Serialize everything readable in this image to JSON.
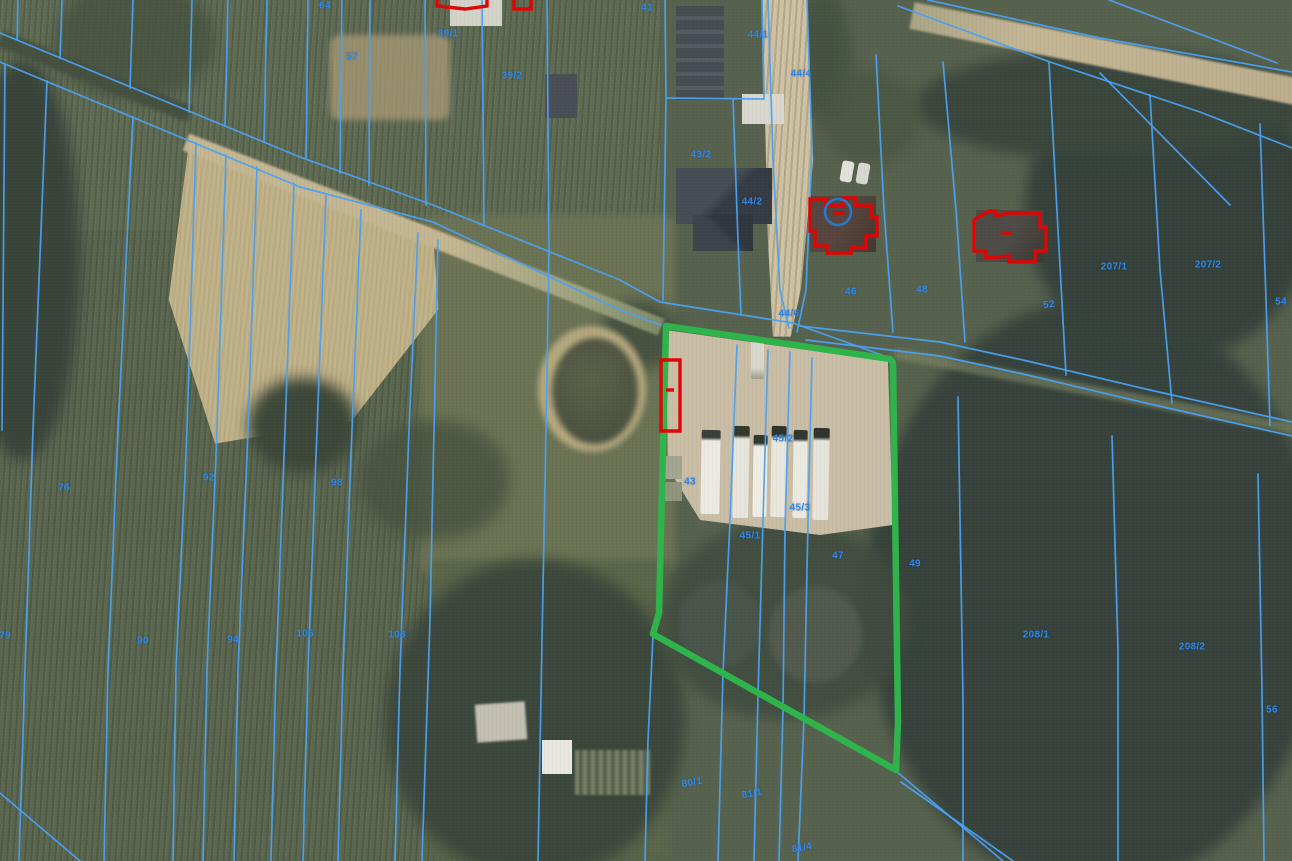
{
  "map": {
    "type": "aerial-cadastral-map",
    "colors": {
      "parcel_line": "#4aa1f2",
      "parcel_label": "#2e86e8",
      "selection_outline": "#2eb44b",
      "building_outline": "#e00505",
      "annotation_circle": "#2679c8"
    },
    "selected_parcel": {
      "points": [
        [
          666,
          326
        ],
        [
          890,
          359
        ],
        [
          893,
          363
        ],
        [
          898,
          722
        ],
        [
          896,
          770
        ],
        [
          653,
          634
        ],
        [
          659,
          613
        ],
        [
          666,
          326
        ]
      ]
    },
    "annotation": {
      "circle": {
        "cx": 838,
        "cy": 212,
        "r": 13
      }
    },
    "building_outlines": [
      {
        "id": "outbuilding-strip",
        "closed": true,
        "points": [
          [
            661,
            360
          ],
          [
            680,
            360
          ],
          [
            680,
            431
          ],
          [
            661,
            431
          ]
        ]
      },
      {
        "id": "outbuilding-strip-mark",
        "closed": false,
        "points": [
          [
            666,
            390
          ],
          [
            674,
            390
          ]
        ]
      },
      {
        "id": "house-a",
        "closed": true,
        "points": [
          [
            810,
            214
          ],
          [
            810,
            199
          ],
          [
            826,
            199
          ],
          [
            826,
            206
          ],
          [
            843,
            206
          ],
          [
            843,
            198
          ],
          [
            855,
            198
          ],
          [
            855,
            206
          ],
          [
            871,
            206
          ],
          [
            871,
            217
          ],
          [
            877,
            217
          ],
          [
            877,
            236
          ],
          [
            866,
            236
          ],
          [
            866,
            248
          ],
          [
            851,
            248
          ],
          [
            851,
            253
          ],
          [
            827,
            253
          ],
          [
            827,
            246
          ],
          [
            815,
            246
          ],
          [
            815,
            231
          ],
          [
            810,
            231
          ]
        ]
      },
      {
        "id": "house-a-mark",
        "closed": false,
        "points": [
          [
            833,
            213
          ],
          [
            844,
            213
          ]
        ]
      },
      {
        "id": "house-b",
        "closed": true,
        "points": [
          [
            974,
            220
          ],
          [
            989,
            211
          ],
          [
            996,
            211
          ],
          [
            996,
            216
          ],
          [
            1009,
            213
          ],
          [
            1040,
            213
          ],
          [
            1040,
            227
          ],
          [
            1046,
            227
          ],
          [
            1046,
            251
          ],
          [
            1035,
            251
          ],
          [
            1035,
            262
          ],
          [
            1009,
            262
          ],
          [
            1009,
            256
          ],
          [
            986,
            258
          ],
          [
            986,
            251
          ],
          [
            974,
            251
          ]
        ]
      },
      {
        "id": "house-b-mark",
        "closed": false,
        "points": [
          [
            1002,
            233
          ],
          [
            1012,
            233
          ]
        ]
      },
      {
        "id": "top-partial-1",
        "closed": false,
        "points": [
          [
            437,
            0
          ],
          [
            437,
            6
          ],
          [
            465,
            9
          ],
          [
            487,
            6
          ],
          [
            487,
            0
          ]
        ]
      },
      {
        "id": "top-partial-2",
        "closed": false,
        "points": [
          [
            514,
            0
          ],
          [
            514,
            9
          ],
          [
            531,
            9
          ],
          [
            531,
            0
          ]
        ]
      }
    ],
    "parcel_labels": [
      {
        "t": "64",
        "x": 325,
        "y": 6
      },
      {
        "t": "41",
        "x": 647,
        "y": 8
      },
      {
        "t": "57",
        "x": 352,
        "y": 57
      },
      {
        "t": "39/1",
        "x": 448,
        "y": 34
      },
      {
        "t": "39/2",
        "x": 512,
        "y": 76
      },
      {
        "t": "44/1",
        "x": 758,
        "y": 35
      },
      {
        "t": "44/4",
        "x": 801,
        "y": 74
      },
      {
        "t": "43/2",
        "x": 701,
        "y": 155
      },
      {
        "t": "44/2",
        "x": 752,
        "y": 202
      },
      {
        "t": "44/6",
        "x": 789,
        "y": 314
      },
      {
        "t": "46",
        "x": 851,
        "y": 292
      },
      {
        "t": "48",
        "x": 922,
        "y": 290
      },
      {
        "t": "52",
        "x": 1049,
        "y": 305,
        "r": -8
      },
      {
        "t": "207/1",
        "x": 1114,
        "y": 267
      },
      {
        "t": "207/2",
        "x": 1208,
        "y": 265
      },
      {
        "t": "54",
        "x": 1281,
        "y": 302
      },
      {
        "t": "76",
        "x": 64,
        "y": 488
      },
      {
        "t": "92",
        "x": 209,
        "y": 478
      },
      {
        "t": "98",
        "x": 337,
        "y": 483
      },
      {
        "t": "79",
        "x": 5,
        "y": 636
      },
      {
        "t": "90",
        "x": 143,
        "y": 641
      },
      {
        "t": "94",
        "x": 233,
        "y": 640
      },
      {
        "t": "105",
        "x": 305,
        "y": 634
      },
      {
        "t": "108",
        "x": 397,
        "y": 635
      },
      {
        "t": "43",
        "x": 690,
        "y": 482
      },
      {
        "t": "45/2",
        "x": 783,
        "y": 439
      },
      {
        "t": "45/1",
        "x": 750,
        "y": 536
      },
      {
        "t": "45/3",
        "x": 800,
        "y": 508
      },
      {
        "t": "47",
        "x": 838,
        "y": 556
      },
      {
        "t": "49",
        "x": 915,
        "y": 564
      },
      {
        "t": "208/1",
        "x": 1036,
        "y": 635
      },
      {
        "t": "208/2",
        "x": 1192,
        "y": 647
      },
      {
        "t": "56",
        "x": 1272,
        "y": 710
      },
      {
        "t": "80/1",
        "x": 692,
        "y": 783,
        "r": -10
      },
      {
        "t": "81/1",
        "x": 752,
        "y": 794,
        "r": -10
      },
      {
        "t": "81/4",
        "x": 802,
        "y": 848,
        "r": -10
      }
    ],
    "cadastral_lines": [
      {
        "pts": [
          [
            0,
            33
          ],
          [
            300,
            157
          ],
          [
            433,
            205
          ],
          [
            620,
            280
          ],
          [
            660,
            302
          ],
          [
            793,
            323
          ],
          [
            890,
            358
          ]
        ]
      },
      {
        "pts": [
          [
            0,
            62
          ],
          [
            300,
            187
          ],
          [
            433,
            222
          ],
          [
            620,
            310
          ],
          [
            661,
            325
          ]
        ]
      },
      {
        "pts": [
          [
            18,
            0
          ],
          [
            17,
            40
          ]
        ]
      },
      {
        "pts": [
          [
            62,
            0
          ],
          [
            60,
            58
          ]
        ]
      },
      {
        "pts": [
          [
            133,
            0
          ],
          [
            130,
            88
          ]
        ]
      },
      {
        "pts": [
          [
            192,
            0
          ],
          [
            189,
            112
          ]
        ]
      },
      {
        "pts": [
          [
            228,
            0
          ],
          [
            225,
            126
          ]
        ]
      },
      {
        "pts": [
          [
            267,
            0
          ],
          [
            264,
            142
          ]
        ]
      },
      {
        "pts": [
          [
            308,
            0
          ],
          [
            306,
            159
          ]
        ]
      },
      {
        "pts": [
          [
            342,
            0
          ],
          [
            340,
            173
          ]
        ]
      },
      {
        "pts": [
          [
            370,
            0
          ],
          [
            369,
            185
          ]
        ]
      },
      {
        "pts": [
          [
            425,
            0
          ],
          [
            426,
            205
          ]
        ]
      },
      {
        "pts": [
          [
            482,
            0
          ],
          [
            484,
            225
          ]
        ]
      },
      {
        "pts": [
          [
            547,
            0
          ],
          [
            549,
            251
          ],
          [
            546,
            430
          ],
          [
            542,
            640
          ],
          [
            538,
            861
          ]
        ]
      },
      {
        "pts": [
          [
            665,
            0
          ],
          [
            666,
            98
          ],
          [
            663,
            300
          ]
        ]
      },
      {
        "pts": [
          [
            733,
            99
          ],
          [
            738,
            240
          ],
          [
            741,
            315
          ]
        ]
      },
      {
        "pts": [
          [
            762,
            0
          ],
          [
            764,
            99
          ]
        ]
      },
      {
        "pts": [
          [
            666,
            98
          ],
          [
            764,
            99
          ]
        ]
      },
      {
        "pts": [
          [
            768,
            0
          ],
          [
            773,
            160
          ],
          [
            780,
            290
          ],
          [
            789,
            328
          ]
        ]
      },
      {
        "pts": [
          [
            807,
            0
          ],
          [
            812,
            150
          ],
          [
            806,
            290
          ],
          [
            797,
            332
          ]
        ]
      },
      {
        "pts": [
          [
            876,
            55
          ],
          [
            884,
            210
          ],
          [
            893,
            332
          ]
        ]
      },
      {
        "pts": [
          [
            943,
            62
          ],
          [
            956,
            210
          ],
          [
            965,
            342
          ]
        ]
      },
      {
        "pts": [
          [
            1049,
            62
          ],
          [
            1058,
            230
          ],
          [
            1066,
            375
          ]
        ]
      },
      {
        "pts": [
          [
            1150,
            95
          ],
          [
            1160,
            270
          ],
          [
            1172,
            403
          ]
        ]
      },
      {
        "pts": [
          [
            1260,
            124
          ],
          [
            1266,
            300
          ],
          [
            1270,
            425
          ]
        ]
      },
      {
        "pts": [
          [
            928,
            0
          ],
          [
            1100,
            38
          ],
          [
            1292,
            72
          ]
        ]
      },
      {
        "pts": [
          [
            898,
            6
          ],
          [
            1050,
            62
          ],
          [
            1200,
            112
          ],
          [
            1292,
            148
          ]
        ]
      },
      {
        "pts": [
          [
            1109,
            0
          ],
          [
            1277,
            63
          ]
        ]
      },
      {
        "pts": [
          [
            1100,
            73
          ],
          [
            1230,
            205
          ]
        ]
      },
      {
        "pts": [
          [
            800,
            326
          ],
          [
            940,
            342
          ],
          [
            1023,
            360
          ],
          [
            1150,
            390
          ],
          [
            1292,
            422
          ]
        ]
      },
      {
        "pts": [
          [
            806,
            340
          ],
          [
            940,
            356
          ],
          [
            1023,
            374
          ],
          [
            1150,
            404
          ],
          [
            1292,
            436
          ]
        ]
      },
      {
        "pts": [
          [
            5,
            64
          ],
          [
            2,
            430
          ]
        ]
      },
      {
        "pts": [
          [
            47,
            81
          ],
          [
            33,
            430
          ],
          [
            25,
            670
          ],
          [
            19,
            861
          ]
        ]
      },
      {
        "pts": [
          [
            133,
            117
          ],
          [
            118,
            430
          ],
          [
            108,
            670
          ],
          [
            104,
            861
          ]
        ]
      },
      {
        "pts": [
          [
            196,
            143
          ],
          [
            187,
            430
          ],
          [
            176,
            670
          ],
          [
            173,
            861
          ]
        ]
      },
      {
        "pts": [
          [
            226,
            155
          ],
          [
            217,
            430
          ],
          [
            207,
            670
          ],
          [
            203,
            861
          ]
        ]
      },
      {
        "pts": [
          [
            257,
            167
          ],
          [
            248,
            430
          ],
          [
            238,
            670
          ],
          [
            234,
            861
          ]
        ]
      },
      {
        "pts": [
          [
            294,
            183
          ],
          [
            285,
            430
          ],
          [
            276,
            670
          ],
          [
            271,
            861
          ]
        ]
      },
      {
        "pts": [
          [
            326,
            196
          ],
          [
            317,
            430
          ],
          [
            308,
            670
          ],
          [
            303,
            861
          ]
        ]
      },
      {
        "pts": [
          [
            361,
            210
          ],
          [
            352,
            430
          ],
          [
            343,
            670
          ],
          [
            338,
            861
          ]
        ]
      },
      {
        "pts": [
          [
            418,
            233
          ],
          [
            409,
            430
          ],
          [
            400,
            670
          ],
          [
            395,
            861
          ]
        ]
      },
      {
        "pts": [
          [
            438,
            240
          ],
          [
            430,
            620
          ],
          [
            422,
            861
          ]
        ]
      },
      {
        "pts": [
          [
            0,
            793
          ],
          [
            80,
            861
          ]
        ]
      },
      {
        "pts": [
          [
            737,
            345
          ],
          [
            730,
            520
          ],
          [
            723,
            673
          ],
          [
            718,
            861
          ]
        ]
      },
      {
        "pts": [
          [
            768,
            350
          ],
          [
            763,
            520
          ],
          [
            758,
            695
          ],
          [
            754,
            861
          ]
        ]
      },
      {
        "pts": [
          [
            790,
            352
          ],
          [
            785,
            530
          ],
          [
            783,
            710
          ],
          [
            779,
            861
          ]
        ]
      },
      {
        "pts": [
          [
            812,
            358
          ],
          [
            808,
            520
          ],
          [
            804,
            719
          ],
          [
            798,
            861
          ]
        ]
      },
      {
        "pts": [
          [
            653,
            636
          ],
          [
            648,
            740
          ],
          [
            645,
            861
          ]
        ]
      },
      {
        "pts": [
          [
            958,
            397
          ],
          [
            963,
            700
          ],
          [
            963,
            861
          ]
        ]
      },
      {
        "pts": [
          [
            1112,
            436
          ],
          [
            1118,
            650
          ],
          [
            1118,
            861
          ]
        ]
      },
      {
        "pts": [
          [
            1258,
            474
          ],
          [
            1262,
            690
          ],
          [
            1264,
            861
          ]
        ]
      },
      {
        "pts": [
          [
            897,
            772
          ],
          [
            1003,
            861
          ]
        ]
      },
      {
        "pts": [
          [
            901,
            782
          ],
          [
            1013,
            861
          ]
        ]
      }
    ]
  }
}
